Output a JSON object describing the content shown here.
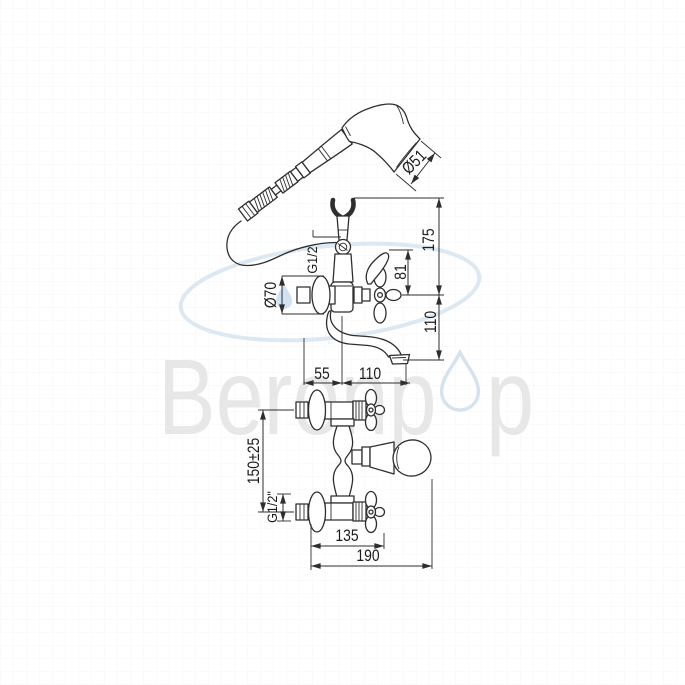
{
  "page": {
    "background_color": "#ffffff"
  },
  "watermark": {
    "brand_text_left": "Berenp",
    "brand_text_right": "p",
    "text_color": "#e7e7e7",
    "ellipse_color": "#d5e3ef",
    "droplet_color": "#cadcee"
  },
  "drawing": {
    "line_color": "#2e2e2e",
    "labels": {
      "handset_diameter": "Ø51",
      "height_total": "175",
      "height_lever": "81",
      "hose_thread": "G1/2",
      "escutcheon_diameter": "Ø70",
      "height_spout": "110",
      "wall_to_axis": "55",
      "axis_to_spout_tip": "110",
      "inlet_center_distance": "150±25",
      "inlet_thread": "G1/2\"",
      "depth_to_handle": "135",
      "depth_overall": "190"
    }
  }
}
